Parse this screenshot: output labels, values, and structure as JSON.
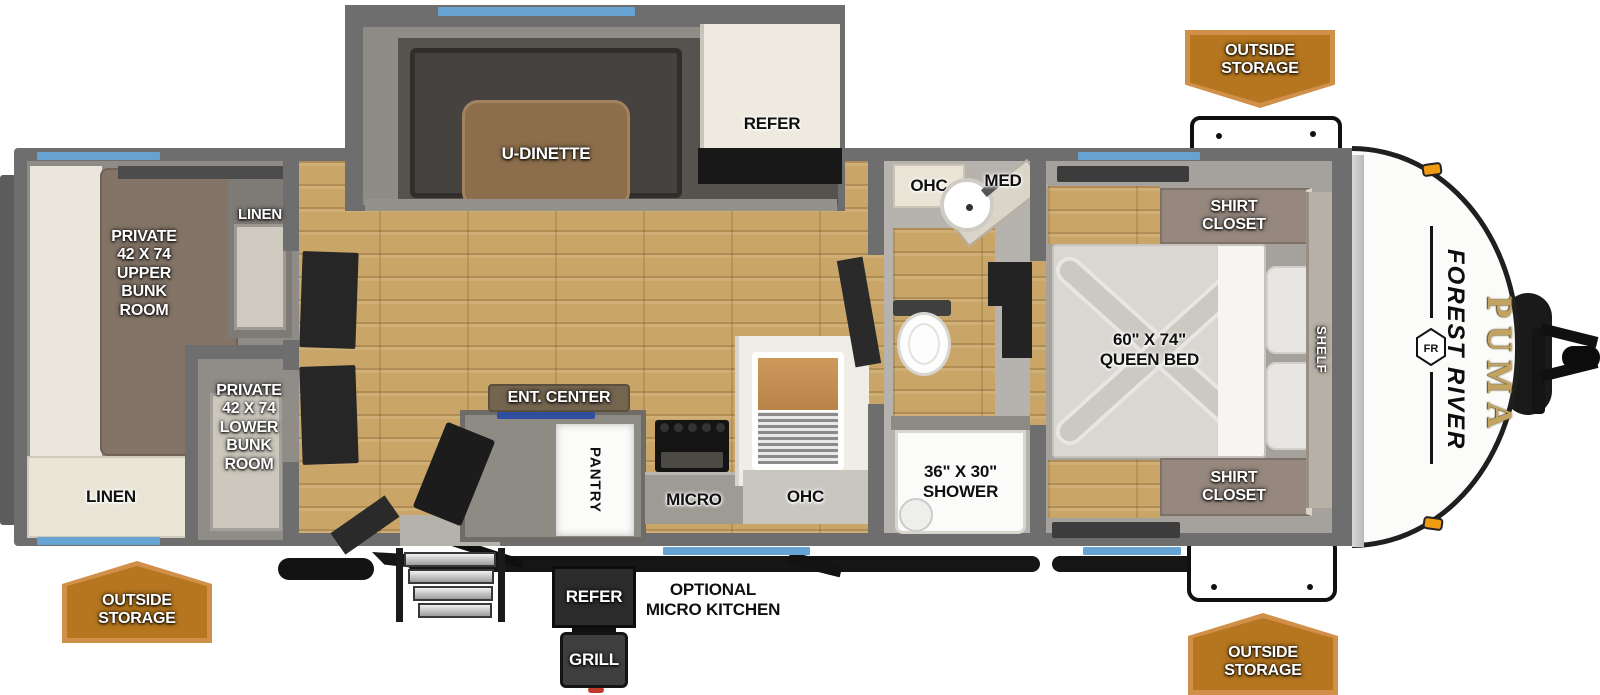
{
  "colors": {
    "window_blue": "#66a3d2",
    "banner_orange": "#b5761f",
    "banner_border": "#d0904a",
    "wall_gray": "#6e6e6e",
    "wood_floor": "#c9a567",
    "brand_gold": "#c2a35f"
  },
  "brand": {
    "maker": "FOREST RIVER",
    "model": "PUMA",
    "logo_monogram": "FR"
  },
  "exterior": {
    "storage_top_right": "OUTSIDE\nSTORAGE",
    "storage_bottom_left": "OUTSIDE\nSTORAGE",
    "storage_bottom_right": "OUTSIDE\nSTORAGE",
    "micro_kitchen": {
      "refer": "REFER",
      "grill": "GRILL",
      "caption": "OPTIONAL\nMICRO KITCHEN"
    }
  },
  "interior": {
    "bunk_room_upper": "PRIVATE\n42 X 74\nUPPER\nBUNK\nROOM",
    "bunk_room_lower": "PRIVATE\n42 X 74\nLOWER\nBUNK\nROOM",
    "linen_upper": "LINEN",
    "linen_lower": "LINEN",
    "dinette": "U-DINETTE",
    "refrigerator": "REFER",
    "entertainment_center": "ENT. CENTER",
    "pantry": "PANTRY",
    "microwave": "MICRO",
    "kitchen_overhead_cabinet": "OHC",
    "bath_overhead_cabinet": "OHC",
    "medicine_cabinet": "MED",
    "shower": "36\" X 30\"\nSHOWER",
    "queen_bed": "60\" X 74\"\nQUEEN BED",
    "shirt_closet_rear": "SHIRT\nCLOSET",
    "shirt_closet_front": "SHIRT\nCLOSET",
    "shelf": "SHELF"
  }
}
